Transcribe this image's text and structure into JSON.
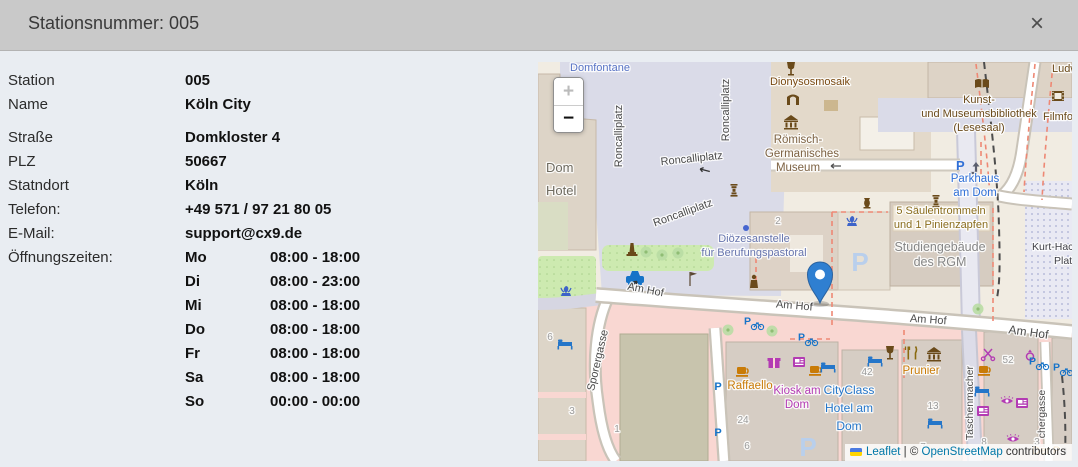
{
  "header": {
    "title": "Stationsnummer: 005",
    "close_glyph": "×"
  },
  "details": {
    "rows": [
      {
        "label": "Station",
        "value": "005"
      },
      {
        "label": "Name",
        "value": "Köln City"
      },
      {
        "label": "Straße",
        "value": "Domkloster 4",
        "gap": true
      },
      {
        "label": "PLZ",
        "value": "50667"
      },
      {
        "label": "Statndort",
        "value": "Köln"
      },
      {
        "label": "Telefon:",
        "value": "+49 571 / 97 21 80 05"
      },
      {
        "label": "E-Mail:",
        "value": "support@cx9.de"
      }
    ],
    "hours_label": "Öffnungszeiten:",
    "hours": [
      {
        "day": "Mo",
        "time": "08:00 - 18:00"
      },
      {
        "day": "Di",
        "time": "08:00 - 23:00"
      },
      {
        "day": "Mi",
        "time": "08:00 - 18:00"
      },
      {
        "day": "Do",
        "time": "08:00 - 18:00"
      },
      {
        "day": "Fr",
        "time": "08:00 - 18:00"
      },
      {
        "day": "Sa",
        "time": "08:00 - 18:00"
      },
      {
        "day": "So",
        "time": "00:00 - 00:00"
      }
    ]
  },
  "map": {
    "zoom_in_label": "+",
    "zoom_out_label": "−",
    "marker_color": "#2f7fd1",
    "attribution": {
      "leaflet_label": "Leaflet",
      "separator": " | © ",
      "osm_label": "OpenStreetMap",
      "suffix": " contributors"
    },
    "colors": {
      "pedestrian": "#dadbe8",
      "building": "#ddd2c6",
      "retail_pink": "#f9d7d2",
      "green": "#cdeab0",
      "street_label": "#4a4a4a",
      "poi_blue": "#2f6fd6",
      "poi_brown": "#6a4a1a",
      "poi_purple": "#b33bb3",
      "poi_orange": "#c97b07"
    },
    "labels": [
      {
        "t": "Domfontane",
        "x": 62,
        "y": 9,
        "c": "#5772c4"
      },
      {
        "t": "Roncalliplatz",
        "x": 84,
        "y": 74,
        "r": -90
      },
      {
        "t": "Roncalliplatz",
        "x": 191,
        "y": 48,
        "r": -90
      },
      {
        "t": "Roncalliplatz",
        "x": 154,
        "y": 100,
        "r": -6
      },
      {
        "t": "Roncalliplatz",
        "x": 146,
        "y": 154,
        "r": -20
      },
      {
        "t": "Am Hof",
        "x": 107,
        "y": 231,
        "r": 11
      },
      {
        "t": "Am Hof",
        "x": 256,
        "y": 247,
        "r": 5
      },
      {
        "t": "Am Hof",
        "x": 390,
        "y": 261,
        "r": 4
      },
      {
        "t": "Am Hof",
        "x": 490,
        "y": 274,
        "r": 8,
        "s": 12
      },
      {
        "t": "Sporergasse",
        "x": 63,
        "y": 299,
        "r": -77
      },
      {
        "t": "Taschenmacher",
        "x": 435,
        "y": 341,
        "r": -90,
        "s": 10.5
      },
      {
        "t": "chergasse",
        "x": 507,
        "y": 352,
        "r": -90,
        "s": 10.5
      },
      {
        "t": "Kurt-Hack",
        "x": 494,
        "y": 188,
        "a": "s",
        "s": 10.5,
        "c": "#3f3f46"
      },
      {
        "t": "Plat",
        "x": 516,
        "y": 202,
        "a": "s",
        "s": 10.5,
        "c": "#3f3f46"
      },
      {
        "t": "Dom",
        "x": 8,
        "y": 110,
        "a": "s",
        "s": 13,
        "c": "#6f6b60"
      },
      {
        "t": "Hotel",
        "x": 8,
        "y": 133,
        "a": "s",
        "s": 13,
        "c": "#6f6b60"
      },
      {
        "t": "Dionysosmosaik",
        "x": 272,
        "y": 23,
        "c": "#7a4a12"
      },
      {
        "t": "Römisch-",
        "x": 260,
        "y": 81,
        "s": 11.5,
        "c": "#7d6243"
      },
      {
        "t": "Germanisches",
        "x": 264,
        "y": 95,
        "s": 11.5,
        "c": "#7d6243"
      },
      {
        "t": "Museum",
        "x": 260,
        "y": 109,
        "s": 11.5,
        "c": "#7d6243"
      },
      {
        "t": "Kunst-",
        "x": 441,
        "y": 41,
        "c": "#6a4a1a"
      },
      {
        "t": "und Museumsbibliothek",
        "x": 441,
        "y": 55,
        "c": "#6a4a1a"
      },
      {
        "t": "(Lesesaal)",
        "x": 441,
        "y": 69,
        "c": "#6a4a1a"
      },
      {
        "t": "Filmfo",
        "x": 505,
        "y": 58,
        "a": "s",
        "c": "#6a4a1a"
      },
      {
        "t": "Ludw",
        "x": 514,
        "y": 10,
        "a": "s",
        "c": "#6a4a1a"
      },
      {
        "t": "Parkhaus",
        "x": 437,
        "y": 120,
        "c": "#2f6fd6",
        "s": 11.5
      },
      {
        "t": "am Dom",
        "x": 437,
        "y": 134,
        "c": "#2f6fd6",
        "s": 11.5
      },
      {
        "t": "Diözesanstelle",
        "x": 216,
        "y": 180,
        "c": "#6674ad"
      },
      {
        "t": "für Berufungspastoral",
        "x": 216,
        "y": 194,
        "c": "#6674ad"
      },
      {
        "t": "5 Säulentrommeln",
        "x": 403,
        "y": 152,
        "c": "#8a6d1d"
      },
      {
        "t": "und 1 Pinienzapfen",
        "x": 403,
        "y": 166,
        "c": "#8a6d1d"
      },
      {
        "t": "Studiengebäude",
        "x": 402,
        "y": 189,
        "c": "#868686",
        "s": 12.5
      },
      {
        "t": "des RGM",
        "x": 402,
        "y": 204,
        "c": "#868686",
        "s": 12.5
      },
      {
        "t": "Raffaello",
        "x": 212,
        "y": 327,
        "c": "#c97b07",
        "s": 11.5
      },
      {
        "t": "Kiosk am",
        "x": 259,
        "y": 332,
        "c": "#b33bb3",
        "s": 11.5
      },
      {
        "t": "Dom",
        "x": 259,
        "y": 346,
        "c": "#b33bb3",
        "s": 11.5
      },
      {
        "t": "CityClass",
        "x": 311,
        "y": 332,
        "c": "#2576c9",
        "s": 12
      },
      {
        "t": "Hotel am",
        "x": 311,
        "y": 350,
        "c": "#2576c9",
        "s": 12
      },
      {
        "t": "Dom",
        "x": 311,
        "y": 368,
        "c": "#2576c9",
        "s": 12
      },
      {
        "t": "Prunier",
        "x": 383,
        "y": 312,
        "c": "#c97b07",
        "s": 11.5
      },
      {
        "t": "Der P",
        "x": 494,
        "y": 392,
        "a": "s",
        "c": "#c97b07"
      },
      {
        "t": "2",
        "x": 240,
        "y": 162,
        "c": "#9b9b9b",
        "s": 10
      },
      {
        "t": "42",
        "x": 329,
        "y": 313,
        "c": "#9b9b9b",
        "s": 10
      },
      {
        "t": "13",
        "x": 395,
        "y": 347,
        "c": "#9b9b9b",
        "s": 10
      },
      {
        "t": "24",
        "x": 205,
        "y": 361,
        "c": "#9b9b9b",
        "s": 10
      },
      {
        "t": "52",
        "x": 470,
        "y": 301,
        "c": "#9b9b9b",
        "s": 10
      },
      {
        "t": "8",
        "x": 446,
        "y": 383,
        "c": "#9b9b9b",
        "s": 10
      },
      {
        "t": "7",
        "x": 385,
        "y": 388,
        "c": "#9b9b9b",
        "s": 10
      },
      {
        "t": "6",
        "x": 12,
        "y": 278,
        "c": "#9b9b9b",
        "s": 10
      },
      {
        "t": "3",
        "x": 34,
        "y": 352,
        "c": "#9b9b9b",
        "s": 10
      },
      {
        "t": "1",
        "x": 79,
        "y": 370,
        "c": "#9b9b9b",
        "s": 10
      },
      {
        "t": "6",
        "x": 209,
        "y": 387,
        "c": "#9b9b9b",
        "s": 10
      },
      {
        "t": "3",
        "x": 499,
        "y": 383,
        "c": "#9b9b9b",
        "s": 10
      }
    ],
    "icons": [
      {
        "t": "taxi",
        "x": 97,
        "y": 217,
        "c": "#1673c8"
      },
      {
        "t": "fountain",
        "x": 28,
        "y": 230,
        "c": "#3d63c9"
      },
      {
        "t": "fountain",
        "x": 314,
        "y": 160,
        "c": "#3d63c9"
      },
      {
        "t": "monument",
        "x": 94,
        "y": 190,
        "c": "#6a4a1a"
      },
      {
        "t": "person",
        "x": 216,
        "y": 220,
        "c": "#6a4a1a"
      },
      {
        "t": "flag",
        "x": 152,
        "y": 218,
        "c": "#5a4632"
      },
      {
        "t": "column",
        "x": 196,
        "y": 130,
        "c": "#6a4a1a"
      },
      {
        "t": "column",
        "x": 398,
        "y": 141,
        "c": "#6a4a1a"
      },
      {
        "t": "amphora",
        "x": 329,
        "y": 142,
        "c": "#6a4a1a"
      },
      {
        "t": "dot",
        "x": 208,
        "y": 166,
        "c": "#4565d0"
      },
      {
        "t": "wine",
        "x": 253,
        "y": 7,
        "c": "#6a4a1a"
      },
      {
        "t": "arch",
        "x": 255,
        "y": 38,
        "c": "#6a4a1a"
      },
      {
        "t": "museum",
        "x": 253,
        "y": 60,
        "c": "#6a4a1a"
      },
      {
        "t": "book",
        "x": 444,
        "y": 22,
        "c": "#6a4a1a"
      },
      {
        "t": "film",
        "x": 520,
        "y": 34,
        "c": "#6a4a1a"
      },
      {
        "t": "cup",
        "x": 205,
        "y": 309,
        "c": "#c97b07"
      },
      {
        "t": "cup",
        "x": 278,
        "y": 308,
        "c": "#c97b07"
      },
      {
        "t": "cup",
        "x": 447,
        "y": 308,
        "c": "#c97b07"
      },
      {
        "t": "gift",
        "x": 236,
        "y": 301,
        "c": "#b33bb3"
      },
      {
        "t": "news",
        "x": 261,
        "y": 300,
        "c": "#b33bb3"
      },
      {
        "t": "news",
        "x": 484,
        "y": 341,
        "c": "#b33bb3"
      },
      {
        "t": "news",
        "x": 445,
        "y": 349,
        "c": "#b33bb3"
      },
      {
        "t": "eye",
        "x": 469,
        "y": 339,
        "c": "#b33bb3"
      },
      {
        "t": "eye",
        "x": 475,
        "y": 377,
        "c": "#b33bb3"
      },
      {
        "t": "scissors",
        "x": 450,
        "y": 292,
        "c": "#b33bb3"
      },
      {
        "t": "ring",
        "x": 492,
        "y": 294,
        "c": "#b33bb3"
      },
      {
        "t": "pbike",
        "x": 215,
        "y": 260,
        "c": "#1673c8"
      },
      {
        "t": "pbike",
        "x": 269,
        "y": 276,
        "c": "#1673c8"
      },
      {
        "t": "pbike",
        "x": 500,
        "y": 300,
        "c": "#1673c8"
      },
      {
        "t": "pbike",
        "x": 524,
        "y": 306,
        "c": "#1673c8"
      },
      {
        "t": "p",
        "x": 180,
        "y": 324,
        "c": "#1673c8"
      },
      {
        "t": "p",
        "x": 180,
        "y": 370,
        "c": "#1673c8"
      },
      {
        "t": "pbig",
        "x": 322,
        "y": 200,
        "c": "#b9cfec"
      },
      {
        "t": "pbig",
        "x": 270,
        "y": 385,
        "c": "#b9cfec"
      },
      {
        "t": "pram",
        "x": 430,
        "y": 104,
        "c": "#2f6fd6"
      },
      {
        "t": "bed",
        "x": 27,
        "y": 282,
        "c": "#2576c9"
      },
      {
        "t": "bed",
        "x": 290,
        "y": 305,
        "c": "#2576c9"
      },
      {
        "t": "bed",
        "x": 337,
        "y": 299,
        "c": "#2576c9"
      },
      {
        "t": "bed",
        "x": 397,
        "y": 361,
        "c": "#2576c9"
      },
      {
        "t": "bed",
        "x": 444,
        "y": 329,
        "c": "#2576c9"
      },
      {
        "t": "wine",
        "x": 352,
        "y": 291,
        "c": "#6a4a1a"
      },
      {
        "t": "forkknife",
        "x": 374,
        "y": 291,
        "c": "#8a6a10"
      },
      {
        "t": "museum",
        "x": 396,
        "y": 292,
        "c": "#6a4a1a"
      },
      {
        "t": "tree",
        "x": 108,
        "y": 190
      },
      {
        "t": "tree",
        "x": 124,
        "y": 193
      },
      {
        "t": "tree",
        "x": 140,
        "y": 191
      },
      {
        "t": "tree",
        "x": 190,
        "y": 268
      },
      {
        "t": "tree",
        "x": 234,
        "y": 269
      },
      {
        "t": "tree",
        "x": 440,
        "y": 247
      },
      {
        "t": "arrow",
        "x": 166,
        "y": 108,
        "c": "#333333",
        "r": 15
      },
      {
        "t": "arrow",
        "x": 96,
        "y": 222,
        "c": "#333333",
        "r": 140
      },
      {
        "t": "arrow",
        "x": 297,
        "y": 104,
        "c": "#555555"
      }
    ]
  }
}
